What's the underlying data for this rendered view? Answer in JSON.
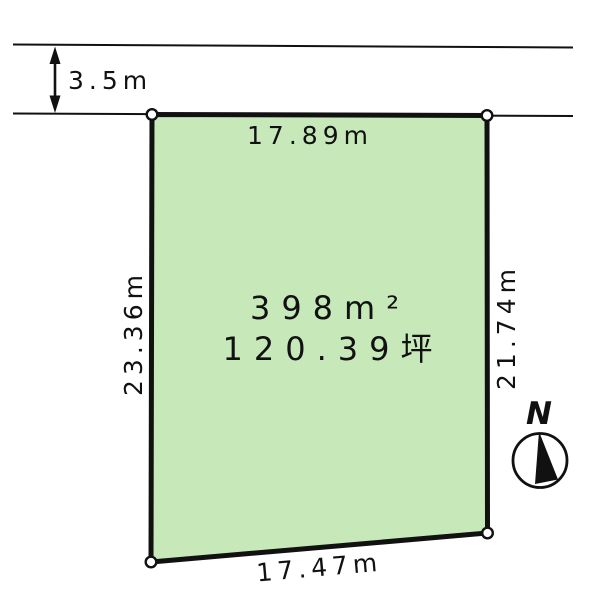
{
  "diagram": {
    "road": {
      "width_label": "3.5m"
    },
    "plot": {
      "area_label": "398m²",
      "area_tsubo_label": "120.39坪",
      "top_edge_label": "17.89m",
      "left_edge_label": "23.36m",
      "right_edge_label": "21.74m",
      "bottom_edge_label": "17.47m"
    },
    "compass": {
      "north_label": "N"
    },
    "colors": {
      "plot_fill": "#c7e9ba",
      "line": "#111111",
      "background": "#ffffff"
    }
  }
}
